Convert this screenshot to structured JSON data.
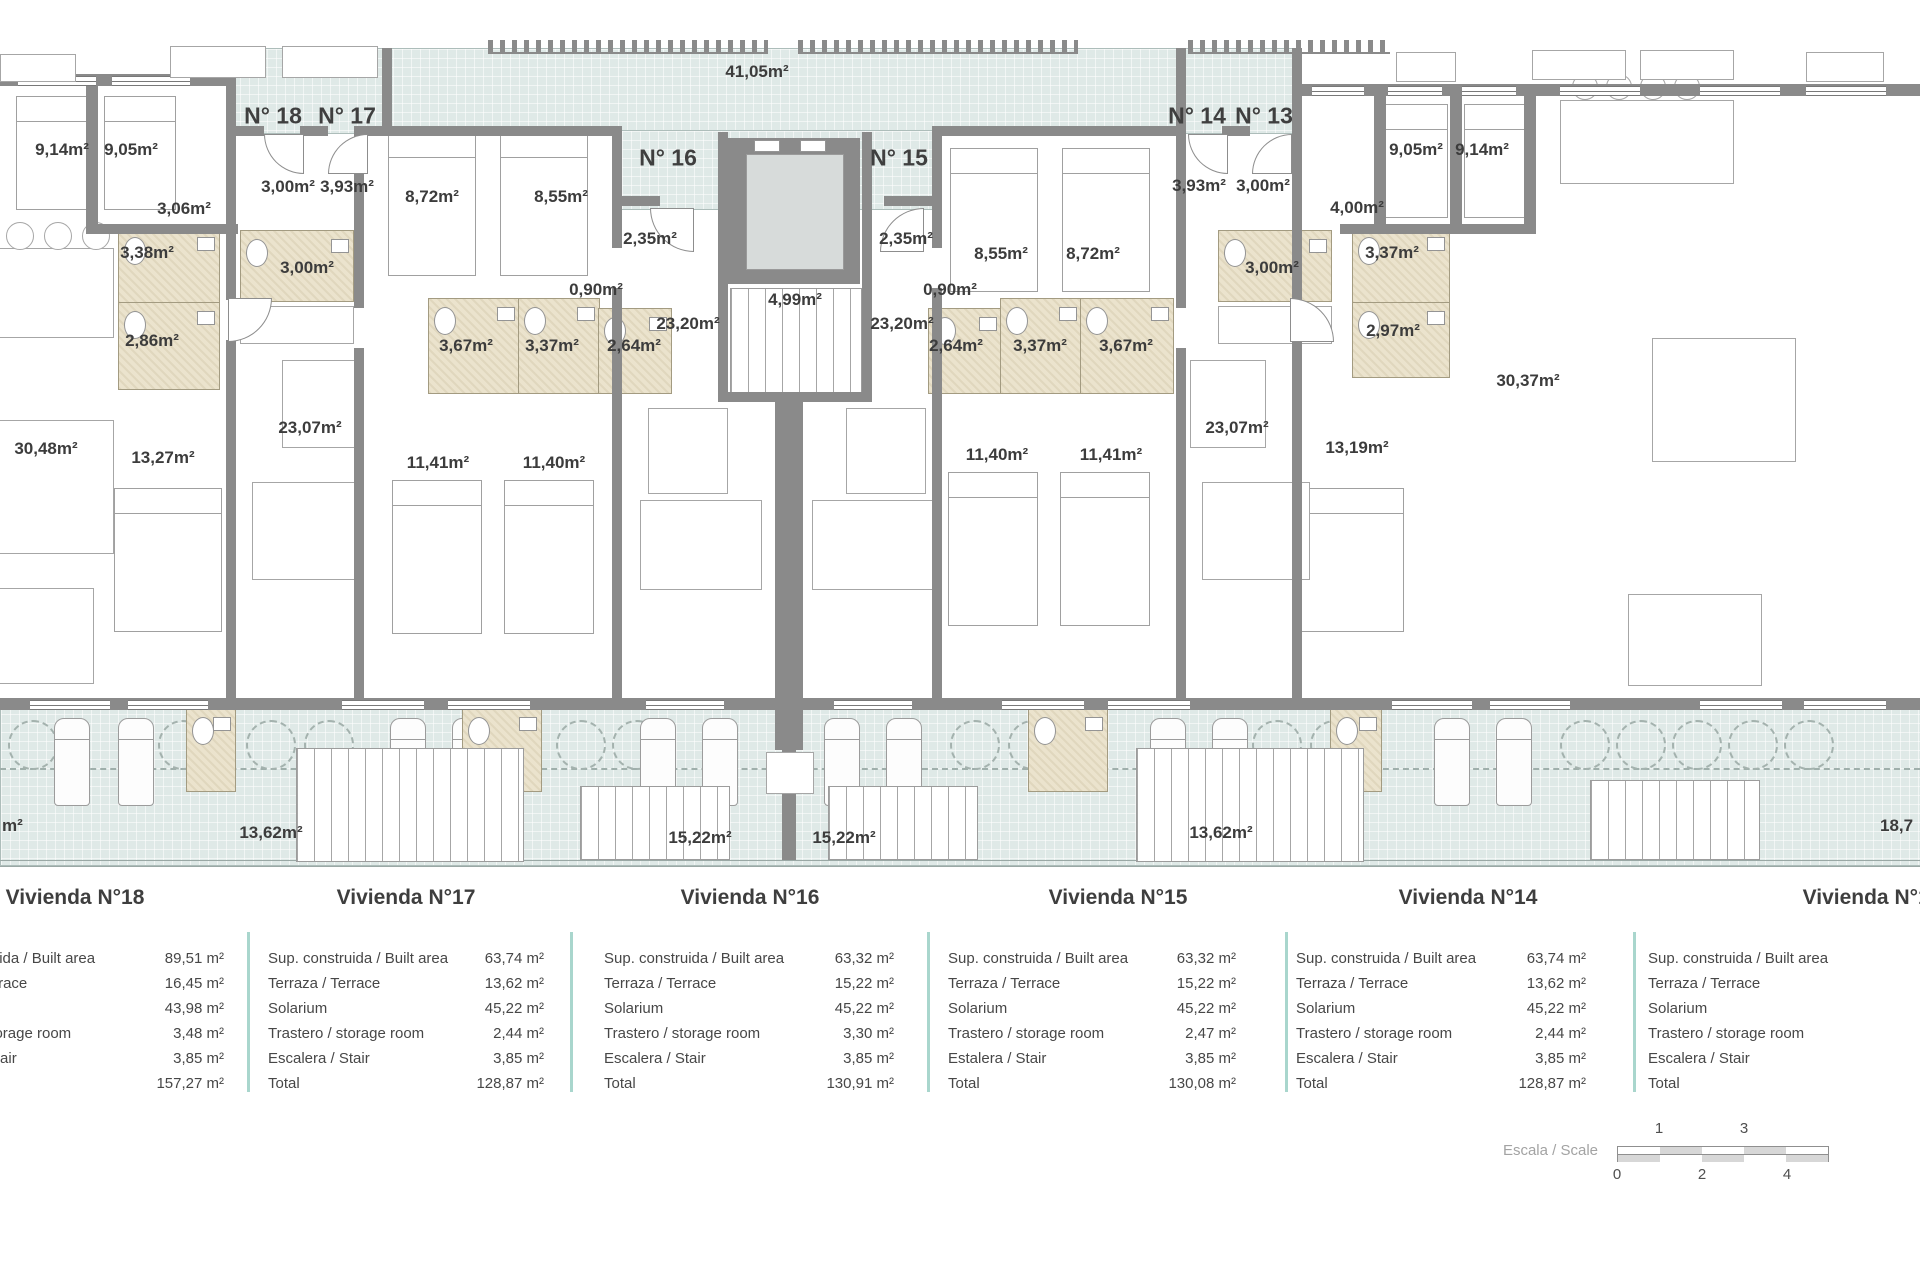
{
  "plan": {
    "unit_markers": [
      "N° 18",
      "N° 17",
      "N° 16",
      "N° 15",
      "N° 14",
      "N° 13"
    ],
    "room_labels": [
      "9,14m²",
      "9,05m²",
      "3,06m²",
      "3,00m²",
      "3,93m²",
      "8,72m²",
      "8,55m²",
      "2,35m²",
      "4,99m²",
      "2,35m²",
      "8,55m²",
      "8,72m²",
      "3,93m²",
      "3,00m²",
      "9,05m²",
      "9,14m²",
      "4,00m²",
      "3,38m²",
      "3,00m²",
      "0,90m²",
      "0,90m²",
      "3,00m²",
      "3,37m²",
      "2,86m²",
      "3,67m²",
      "3,37m²",
      "2,64m²",
      "23,20m²",
      "23,20m²",
      "2,64m²",
      "3,37m²",
      "3,67m²",
      "2,97m²",
      "30,48m²",
      "13,27m²",
      "23,07m²",
      "11,41m²",
      "11,40m²",
      "11,40m²",
      "11,41m²",
      "23,07m²",
      "13,19m²",
      "30,37m²",
      "41,05m²",
      "13,62m²",
      "15,22m²",
      "15,22m²",
      "13,62m²",
      "18,7",
      "m²"
    ]
  },
  "tables": [
    {
      "title": "Vivienda N°18",
      "rows": [
        {
          "label": "Sup. construida / Built area",
          "value": "89,51 m²"
        },
        {
          "label": "Terraza / Terrace",
          "value": "16,45 m²"
        },
        {
          "label": "Solarium",
          "value": "43,98 m²"
        },
        {
          "label": "Trastero / storage room",
          "value": "3,48 m²"
        },
        {
          "label": "Escalera / Stair",
          "value": "3,85 m²"
        },
        {
          "label": "Total",
          "value": "157,27 m²"
        }
      ]
    },
    {
      "title": "Vivienda N°17",
      "rows": [
        {
          "label": "Sup. construida / Built area",
          "value": "63,74 m²"
        },
        {
          "label": "Terraza / Terrace",
          "value": "13,62 m²"
        },
        {
          "label": "Solarium",
          "value": "45,22 m²"
        },
        {
          "label": "Trastero / storage room",
          "value": "2,44 m²"
        },
        {
          "label": "Escalera / Stair",
          "value": "3,85 m²"
        },
        {
          "label": "Total",
          "value": "128,87 m²"
        }
      ]
    },
    {
      "title": "Vivienda N°16",
      "rows": [
        {
          "label": "Sup. construida / Built area",
          "value": "63,32 m²"
        },
        {
          "label": "Terraza / Terrace",
          "value": "15,22 m²"
        },
        {
          "label": "Solarium",
          "value": "45,22 m²"
        },
        {
          "label": "Trastero / storage room",
          "value": "3,30 m²"
        },
        {
          "label": "Escalera / Stair",
          "value": "3,85 m²"
        },
        {
          "label": "Total",
          "value": "130,91 m²"
        }
      ]
    },
    {
      "title": "Vivienda N°15",
      "rows": [
        {
          "label": "Sup. construida / Built area",
          "value": "63,32 m²"
        },
        {
          "label": "Terraza / Terrace",
          "value": "15,22 m²"
        },
        {
          "label": "Solarium",
          "value": "45,22 m²"
        },
        {
          "label": "Trastero / storage room",
          "value": "2,47 m²"
        },
        {
          "label": "Estalera / Stair",
          "value": "3,85 m²"
        },
        {
          "label": "Total",
          "value": "130,08 m²"
        }
      ]
    },
    {
      "title": "Vivienda N°14",
      "rows": [
        {
          "label": "Sup. construida / Built area",
          "value": "63,74 m²"
        },
        {
          "label": "Terraza / Terrace",
          "value": "13,62 m²"
        },
        {
          "label": "Solarium",
          "value": "45,22 m²"
        },
        {
          "label": "Trastero / storage room",
          "value": "2,44 m²"
        },
        {
          "label": "Escalera / Stair",
          "value": "3,85 m²"
        },
        {
          "label": "Total",
          "value": "128,87 m²"
        }
      ]
    },
    {
      "title": "Vivienda N°13",
      "rows": [
        {
          "label": "Sup. construida / Built area",
          "value": ""
        },
        {
          "label": "Terraza / Terrace",
          "value": ""
        },
        {
          "label": "Solarium",
          "value": ""
        },
        {
          "label": "Trastero / storage room",
          "value": ""
        },
        {
          "label": "Escalera / Stair",
          "value": ""
        },
        {
          "label": "Total",
          "value": ""
        }
      ]
    }
  ],
  "scale": {
    "label": "Escala / Scale",
    "ticks_top": [
      "1",
      "3"
    ],
    "ticks_bottom": [
      "0",
      "2",
      "4"
    ]
  },
  "colors": {
    "wall": "#8a8a8a",
    "terrace": "#dfe9e7",
    "bathroom": "#ebe3cd",
    "divider": "#a9d6cd"
  }
}
